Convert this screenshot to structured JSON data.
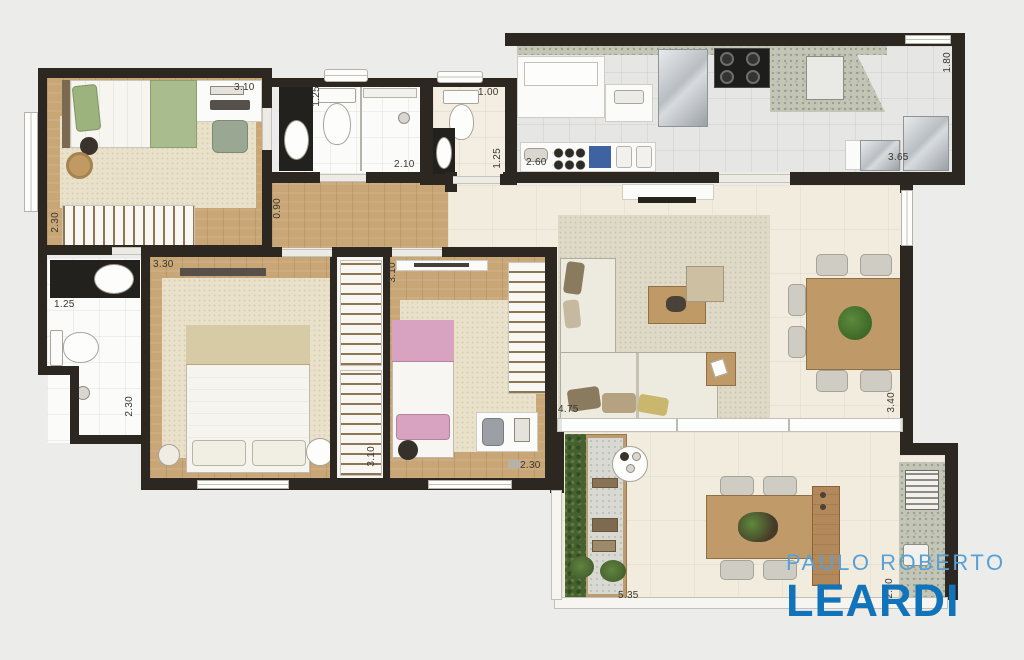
{
  "type": "apartment-floor-plan",
  "brand": {
    "name_top": "PAULO ROBERTO",
    "name_bottom": "LEARDI",
    "color_top": "#57a1d8",
    "color_bottom": "#1173ba"
  },
  "palette": {
    "background": "#ececea",
    "wall": "#2d2721",
    "wood_floor": "#c8a676",
    "rug": "#e9e1c9",
    "living_tile": "#f1ecdd",
    "kitchen_tile": "#e6e6e4",
    "bath_tile": "#fbfbf9",
    "dark_counter": "#23211d",
    "granite": "#c3c6b6",
    "bed_green": "#a9bc8d",
    "bed_pink": "#d8a3c0",
    "garden_green": "#46602f",
    "table_wood": "#bf9a68"
  },
  "dimensions": [
    {
      "id": "bedroom1-width",
      "label": "3.10"
    },
    {
      "id": "bedroom1-depth",
      "label": "2.30"
    },
    {
      "id": "bath1-entry",
      "label": "1.25"
    },
    {
      "id": "bath1-length",
      "label": "2.10"
    },
    {
      "id": "bath2-width",
      "label": "1.00"
    },
    {
      "id": "bath2-depth",
      "label": "1.25"
    },
    {
      "id": "hall-width",
      "label": "0.90"
    },
    {
      "id": "kitchen-left",
      "label": "2.60"
    },
    {
      "id": "kitchen-right",
      "label": "3.65"
    },
    {
      "id": "kitchen-depth",
      "label": "1.80"
    },
    {
      "id": "bath3-width",
      "label": "1.25"
    },
    {
      "id": "bath3-depth",
      "label": "2.30"
    },
    {
      "id": "master-width",
      "label": "3.30"
    },
    {
      "id": "master-depth",
      "label": "3.10"
    },
    {
      "id": "bedroom2-depth",
      "label": "3.10"
    },
    {
      "id": "bedroom2-width",
      "label": "2.30"
    },
    {
      "id": "living-width",
      "label": "4.75"
    },
    {
      "id": "living-depth",
      "label": "3.40"
    },
    {
      "id": "terrace-width",
      "label": "5.35"
    },
    {
      "id": "terrace-depth",
      "label": "2.50"
    }
  ]
}
